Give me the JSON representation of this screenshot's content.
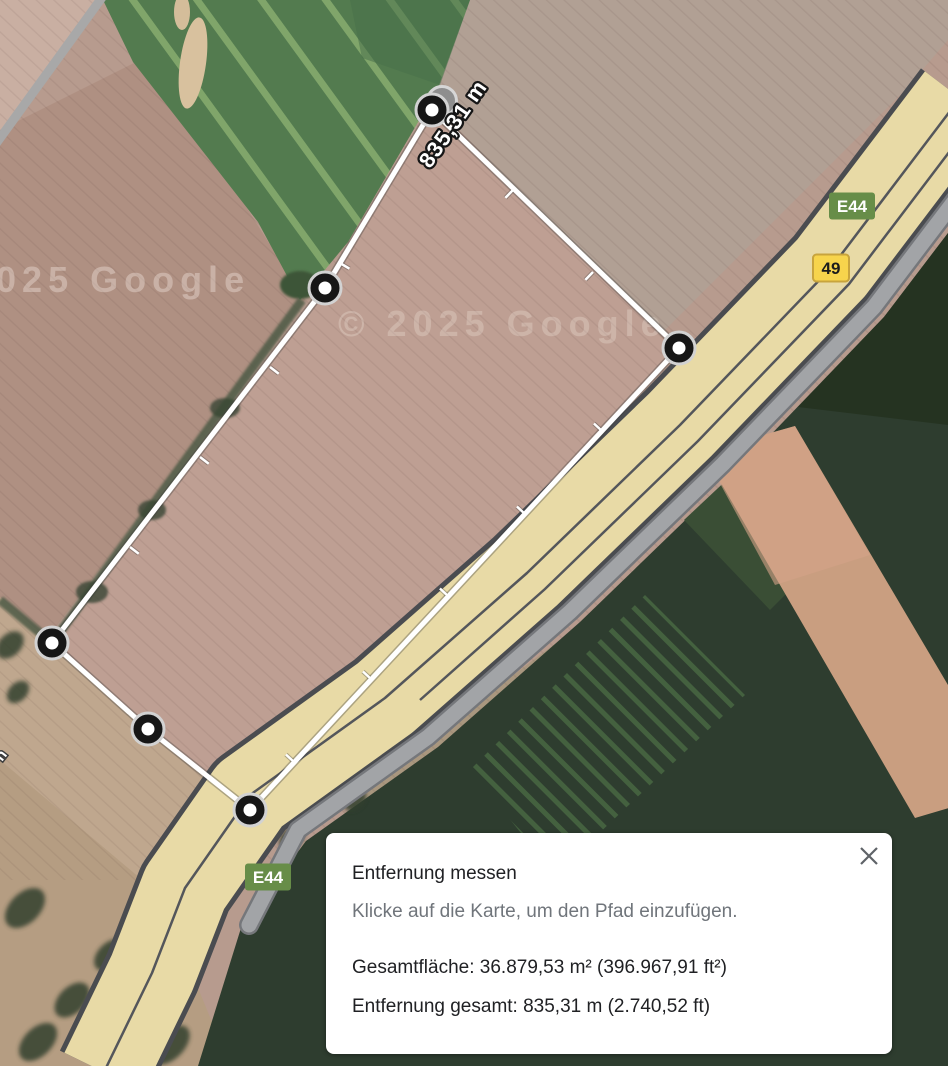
{
  "map": {
    "watermark_partial": "2025 Google",
    "watermark_full": "© 2025 Google",
    "road_label_fragment": "n",
    "badge_e44": "E44",
    "badge_49": "49"
  },
  "colors": {
    "euro_route_badge": "#678d48",
    "national_route_badge": "#f7d44c",
    "measure_line": "#ffffff",
    "highway_fill": "#e8daa6"
  },
  "measurement": {
    "label": "835,31 m",
    "label_pos": {
      "x": 459,
      "y": 128,
      "rotate": -55
    },
    "vertices": [
      {
        "x": 432,
        "y": 110
      },
      {
        "x": 679,
        "y": 348
      },
      {
        "x": 250,
        "y": 810
      },
      {
        "x": 148,
        "y": 729
      },
      {
        "x": 52,
        "y": 643
      },
      {
        "x": 325,
        "y": 288
      }
    ],
    "ghost_vertex": {
      "x": 442,
      "y": 101
    },
    "ticks": [
      {
        "x": 513,
        "y": 190,
        "nx": -0.694,
        "ny": 0.72
      },
      {
        "x": 593,
        "y": 272,
        "nx": -0.694,
        "ny": 0.72
      },
      {
        "x": 602,
        "y": 431,
        "nx": -0.733,
        "ny": -0.681
      },
      {
        "x": 525,
        "y": 514,
        "nx": -0.733,
        "ny": -0.681
      },
      {
        "x": 448,
        "y": 596,
        "nx": -0.733,
        "ny": -0.681
      },
      {
        "x": 371,
        "y": 679,
        "nx": -0.733,
        "ny": -0.681
      },
      {
        "x": 294,
        "y": 762,
        "nx": -0.733,
        "ny": -0.681
      },
      {
        "x": 130,
        "y": 547,
        "nx": 0.792,
        "ny": 0.609
      },
      {
        "x": 200,
        "y": 457,
        "nx": 0.792,
        "ny": 0.609
      },
      {
        "x": 270,
        "y": 367,
        "nx": 0.792,
        "ny": 0.609
      },
      {
        "x": 340,
        "y": 263,
        "nx": 0.856,
        "ny": 0.514
      }
    ]
  },
  "panel": {
    "title": "Entfernung messen",
    "subtitle": "Klicke auf die Karte, um den Pfad einzufügen.",
    "area_line": "Gesamtfläche: 36.879,53 m² (396.967,91 ft²)",
    "distance_line": "Entfernung gesamt: 835,31 m (2.740,52 ft)"
  }
}
